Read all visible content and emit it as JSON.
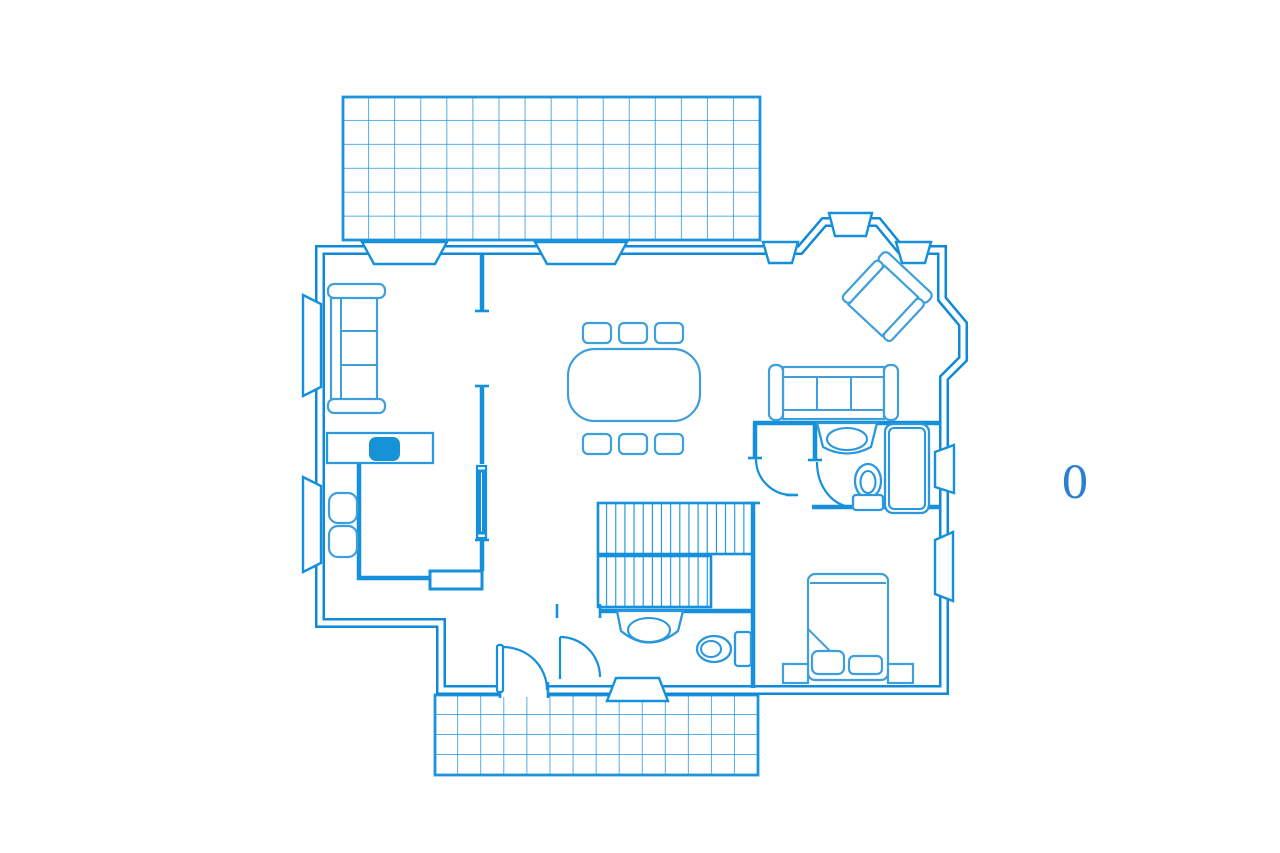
{
  "plan": {
    "level_label": "0"
  },
  "palette": {
    "background": "#ffffff",
    "wall_line": "#0f8ad8",
    "interior_line": "#1490dc",
    "furniture_line": "#3f9fdb",
    "fixture_line": "#2b97dd",
    "deck_grid_line": "#1e93dc",
    "sink_fill": "#1593d6",
    "label_color": "#2b7fd2"
  },
  "elements": [
    "top-deck",
    "bottom-deck",
    "exterior-walls",
    "bay-window",
    "windows",
    "entry-door",
    "interior-doors",
    "pocket-door",
    "stairs",
    "kitchen-counter",
    "kitchen-sink",
    "bar-stools",
    "living-sofa",
    "dining-table",
    "dining-chairs",
    "lounge-sofa",
    "bay-armchair",
    "bathroom-vanity",
    "toilet",
    "shower",
    "lower-bath-vanity",
    "lower-bath-toilet",
    "double-bed",
    "pillows",
    "nightstands",
    "level-label"
  ]
}
